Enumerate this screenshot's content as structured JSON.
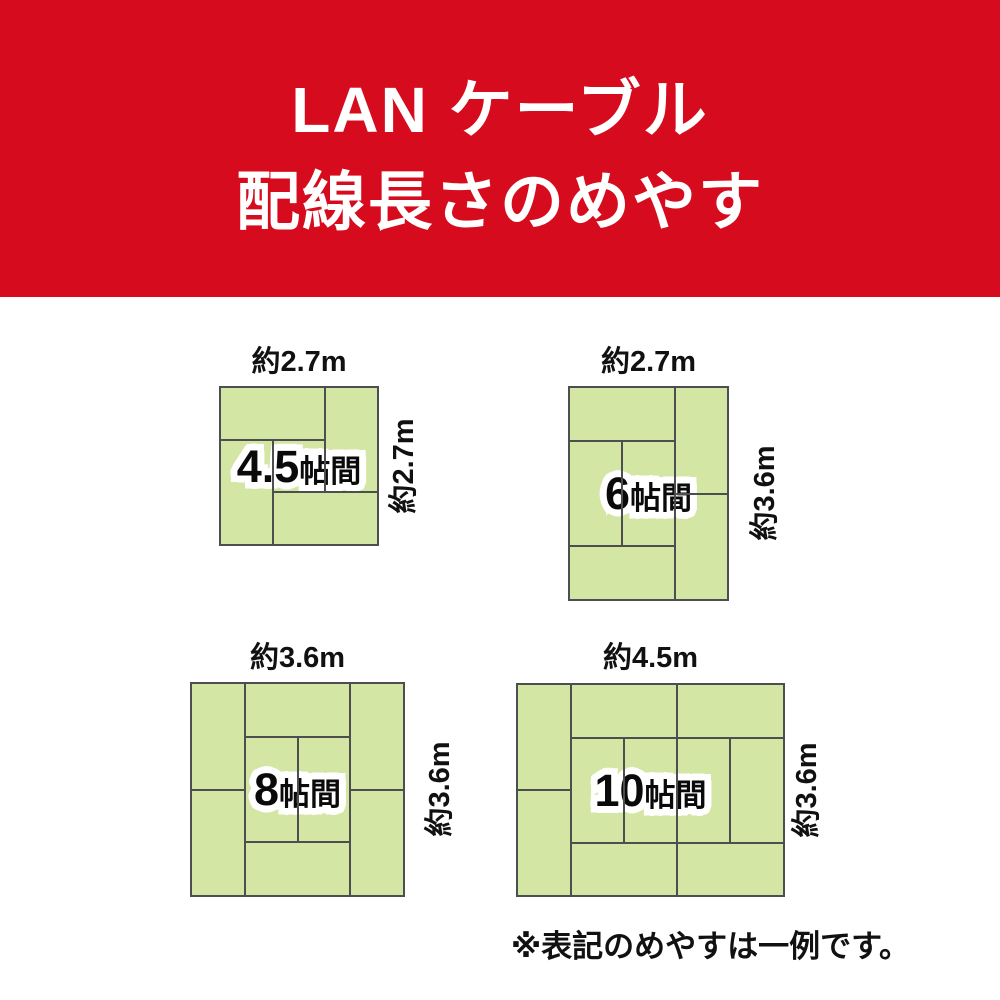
{
  "header": {
    "title_line1": "LAN ケーブル",
    "title_line2": "配線長さのめやす",
    "bg_color": "#d70b1e",
    "text_color": "#ffffff"
  },
  "rooms": [
    {
      "name_number": "4.5",
      "name_suffix": "帖間",
      "top_label": "約2.7m",
      "side_label": "約2.7m",
      "width_m": 2.7,
      "height_m": 2.7,
      "tatami_count": 4.5
    },
    {
      "name_number": "6",
      "name_suffix": "帖間",
      "top_label": "約2.7m",
      "side_label": "約3.6m",
      "width_m": 2.7,
      "height_m": 3.6,
      "tatami_count": 6
    },
    {
      "name_number": "8",
      "name_suffix": "帖間",
      "top_label": "約3.6m",
      "side_label": "約3.6m",
      "width_m": 3.6,
      "height_m": 3.6,
      "tatami_count": 8
    },
    {
      "name_number": "10",
      "name_suffix": "帖間",
      "top_label": "約4.5m",
      "side_label": "約3.6m",
      "width_m": 4.5,
      "height_m": 3.6,
      "tatami_count": 10
    }
  ],
  "footnote": "※表記のめやすは一例です。",
  "colors": {
    "tatami_fill": "#d4e6a4",
    "tatami_line": "#4d4e50",
    "label_text": "#111111"
  },
  "diagram": {
    "rooms": [
      {
        "cols": 3,
        "rows": 3,
        "lines": [
          [
            0,
            1,
            2,
            1
          ],
          [
            2,
            0,
            2,
            2
          ],
          [
            1,
            2,
            3,
            2
          ],
          [
            1,
            1,
            1,
            3
          ]
        ]
      },
      {
        "cols": 3,
        "rows": 4,
        "lines": [
          [
            0,
            1,
            2,
            1
          ],
          [
            2,
            0,
            2,
            4
          ],
          [
            2,
            2,
            3,
            2
          ],
          [
            1,
            1,
            1,
            3
          ],
          [
            0,
            3,
            2,
            3
          ]
        ]
      },
      {
        "cols": 4,
        "rows": 4,
        "lines": [
          [
            1,
            0,
            1,
            4
          ],
          [
            3,
            0,
            3,
            4
          ],
          [
            0,
            2,
            1,
            2
          ],
          [
            3,
            2,
            4,
            2
          ],
          [
            1,
            1,
            3,
            1
          ],
          [
            1,
            3,
            3,
            3
          ],
          [
            2,
            1,
            2,
            3
          ]
        ]
      },
      {
        "cols": 5,
        "rows": 4,
        "lines": [
          [
            1,
            0,
            1,
            4
          ],
          [
            0,
            2,
            1,
            2
          ],
          [
            3,
            0,
            3,
            4
          ],
          [
            1,
            1,
            5,
            1
          ],
          [
            1,
            3,
            5,
            3
          ],
          [
            2,
            1,
            2,
            3
          ],
          [
            4,
            1,
            4,
            3
          ]
        ]
      }
    ]
  }
}
